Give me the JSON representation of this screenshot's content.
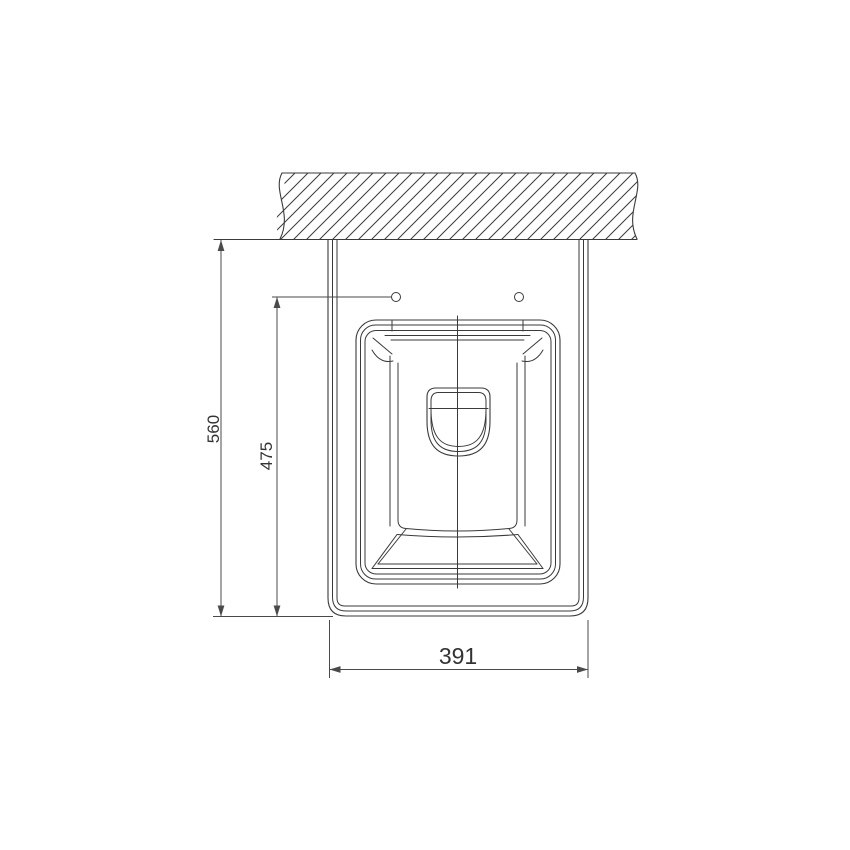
{
  "drawing": {
    "view": "top view — wall-hung sanitary fixture installation drawing",
    "dimensions": {
      "overall_depth_mm": "560",
      "hole_offset_mm": "475",
      "overall_width_mm": "391"
    },
    "mounting_holes_count": 2,
    "colors": {
      "background": "#ffffff",
      "line": "#3a3a3a",
      "dimension_line": "#4a4a4a",
      "text": "#333333"
    }
  }
}
